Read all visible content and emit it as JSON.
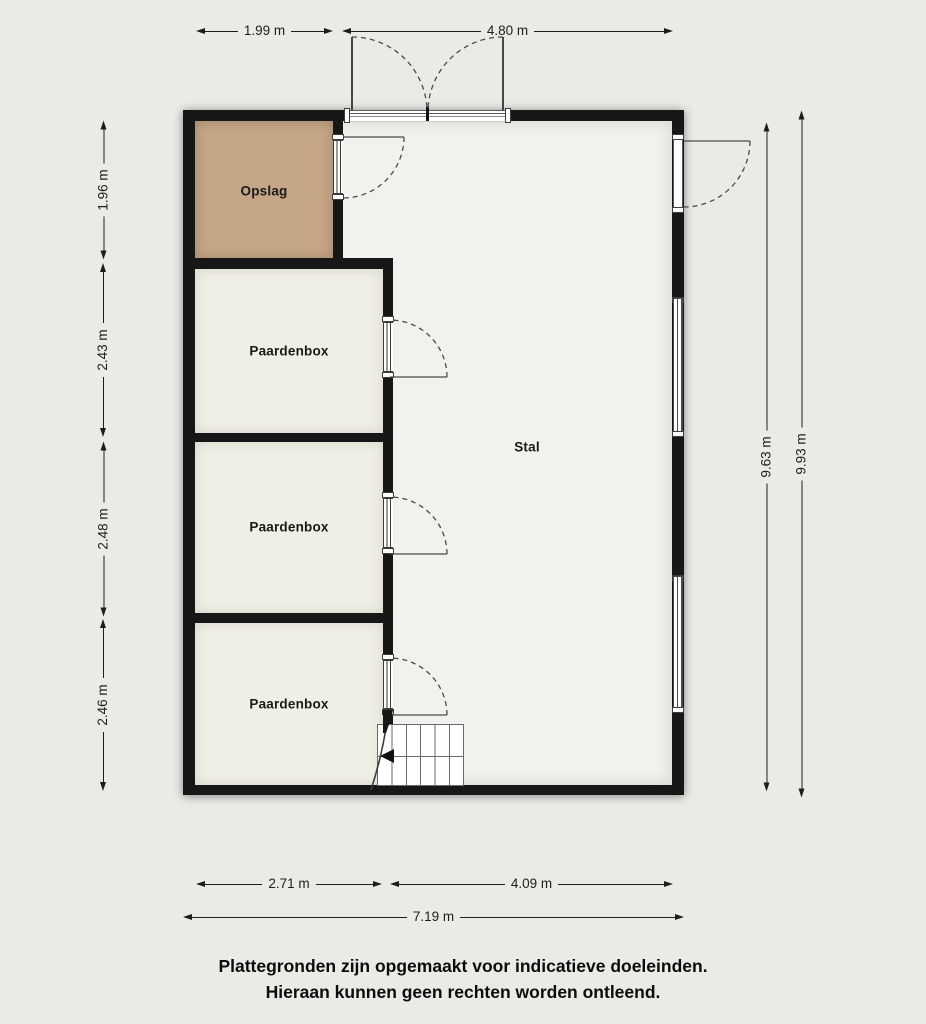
{
  "rooms": {
    "opslag": "Opslag",
    "paardenbox_1": "Paardenbox",
    "paardenbox_2": "Paardenbox",
    "paardenbox_3": "Paardenbox",
    "stal": "Stal"
  },
  "dimensions": {
    "top": [
      "1.99 m",
      "4.80 m"
    ],
    "left": [
      "1.96 m",
      "2.43 m",
      "2.48 m",
      "2.46 m"
    ],
    "right": [
      "9.63 m",
      "9.93 m"
    ],
    "bottom": [
      "2.71 m",
      "4.09 m",
      "7.19 m"
    ]
  },
  "disclaimer": {
    "line1": "Plattegronden zijn opgemaakt voor indicatieve doeleinden.",
    "line2": "Hieraan kunnen geen rechten worden ontleend."
  },
  "colors": {
    "background": "#ECEAE6",
    "wall": "#171717",
    "stal_floor": "#F2F1EE",
    "paardenbox_floor": "#F0EFE5",
    "opslag_floor": "#C5A687",
    "dimension": "#1D1D1D"
  }
}
